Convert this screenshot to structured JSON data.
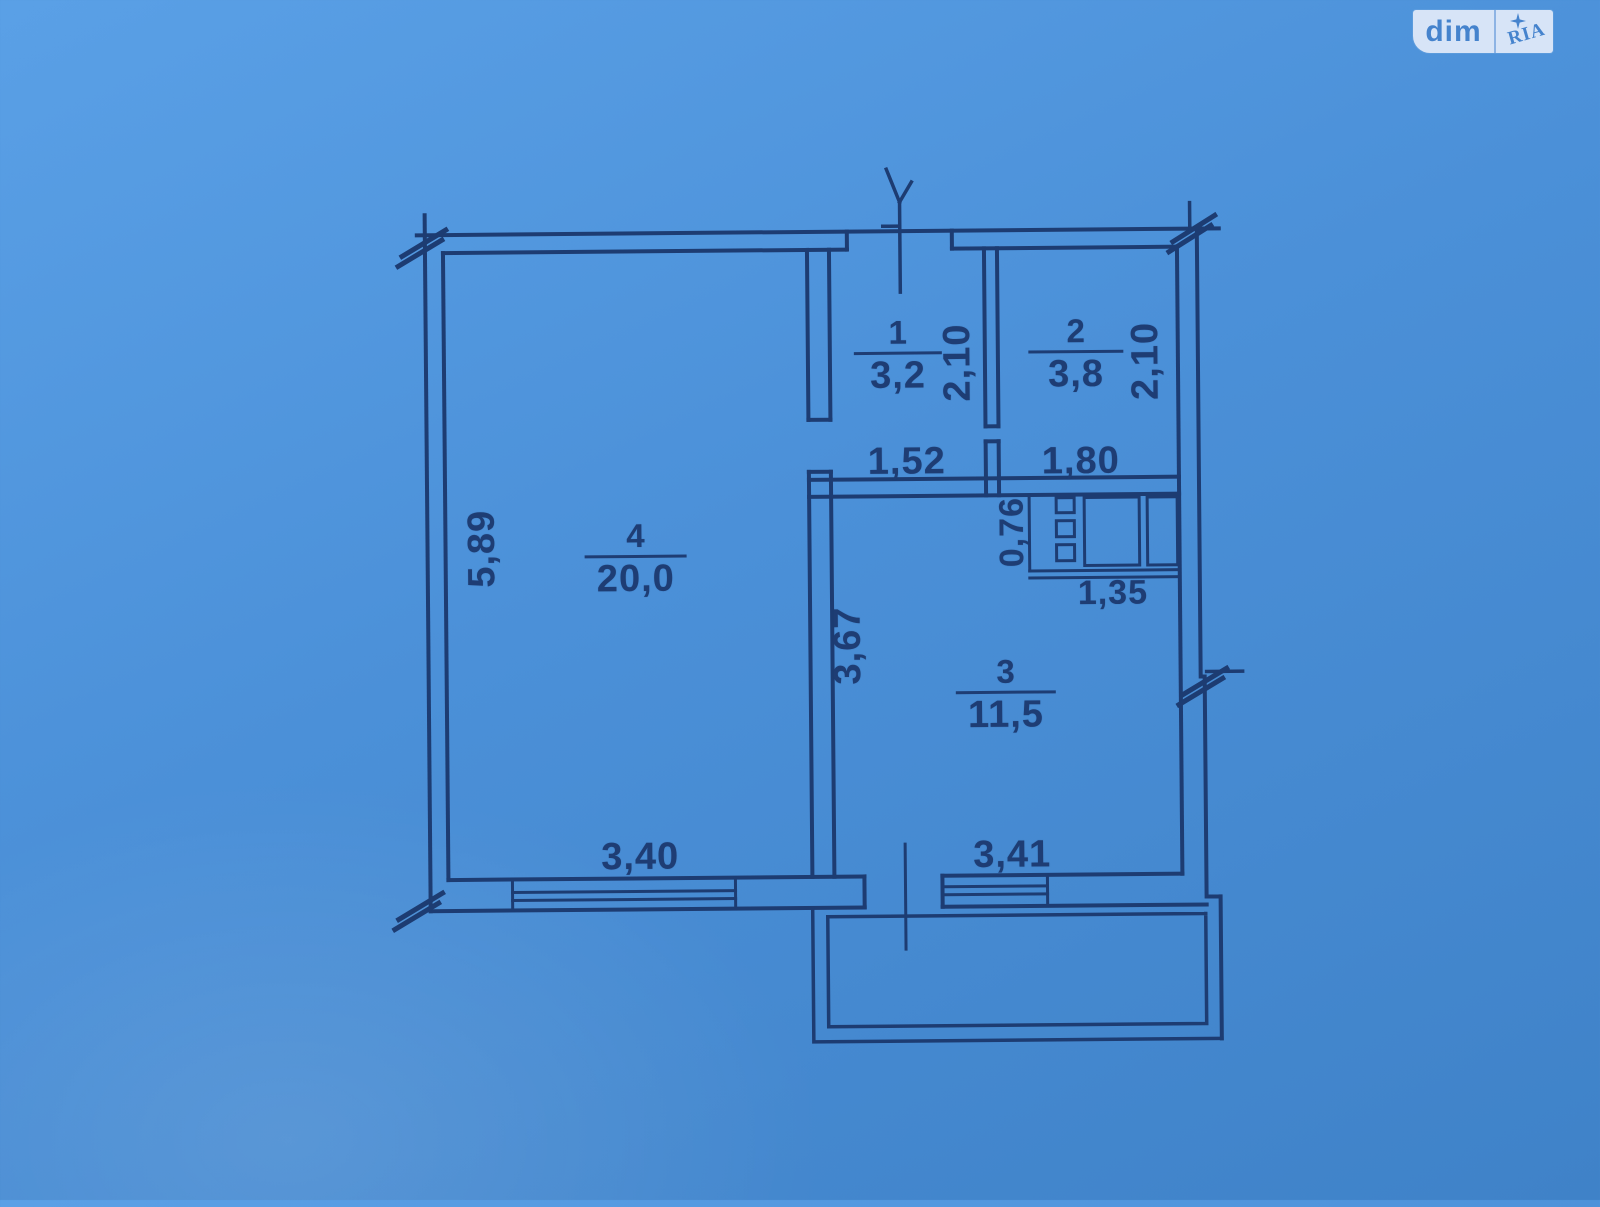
{
  "page": {
    "background_color": "#4b90d8",
    "line_color": "#1d3c72"
  },
  "logo": {
    "dim": "dim",
    "ria": "RIA",
    "box_color": "#d7e4f7",
    "text_color": "#4583cd"
  },
  "plan": {
    "rooms": [
      {
        "number": "1",
        "area": "3,2"
      },
      {
        "number": "2",
        "area": "3,8"
      },
      {
        "number": "3",
        "area": "11,5"
      },
      {
        "number": "4",
        "area": "20,0"
      }
    ],
    "dims": {
      "room1_width": "1,52",
      "room2_width": "1,80",
      "shaft_width": "1,35",
      "room4_width": "3,40",
      "room3_width": "3,41",
      "room1_height": "2,10",
      "room2_height": "2,10",
      "shaft_height": "0,76",
      "room3_height": "3,67",
      "room4_height": "5,89"
    }
  }
}
